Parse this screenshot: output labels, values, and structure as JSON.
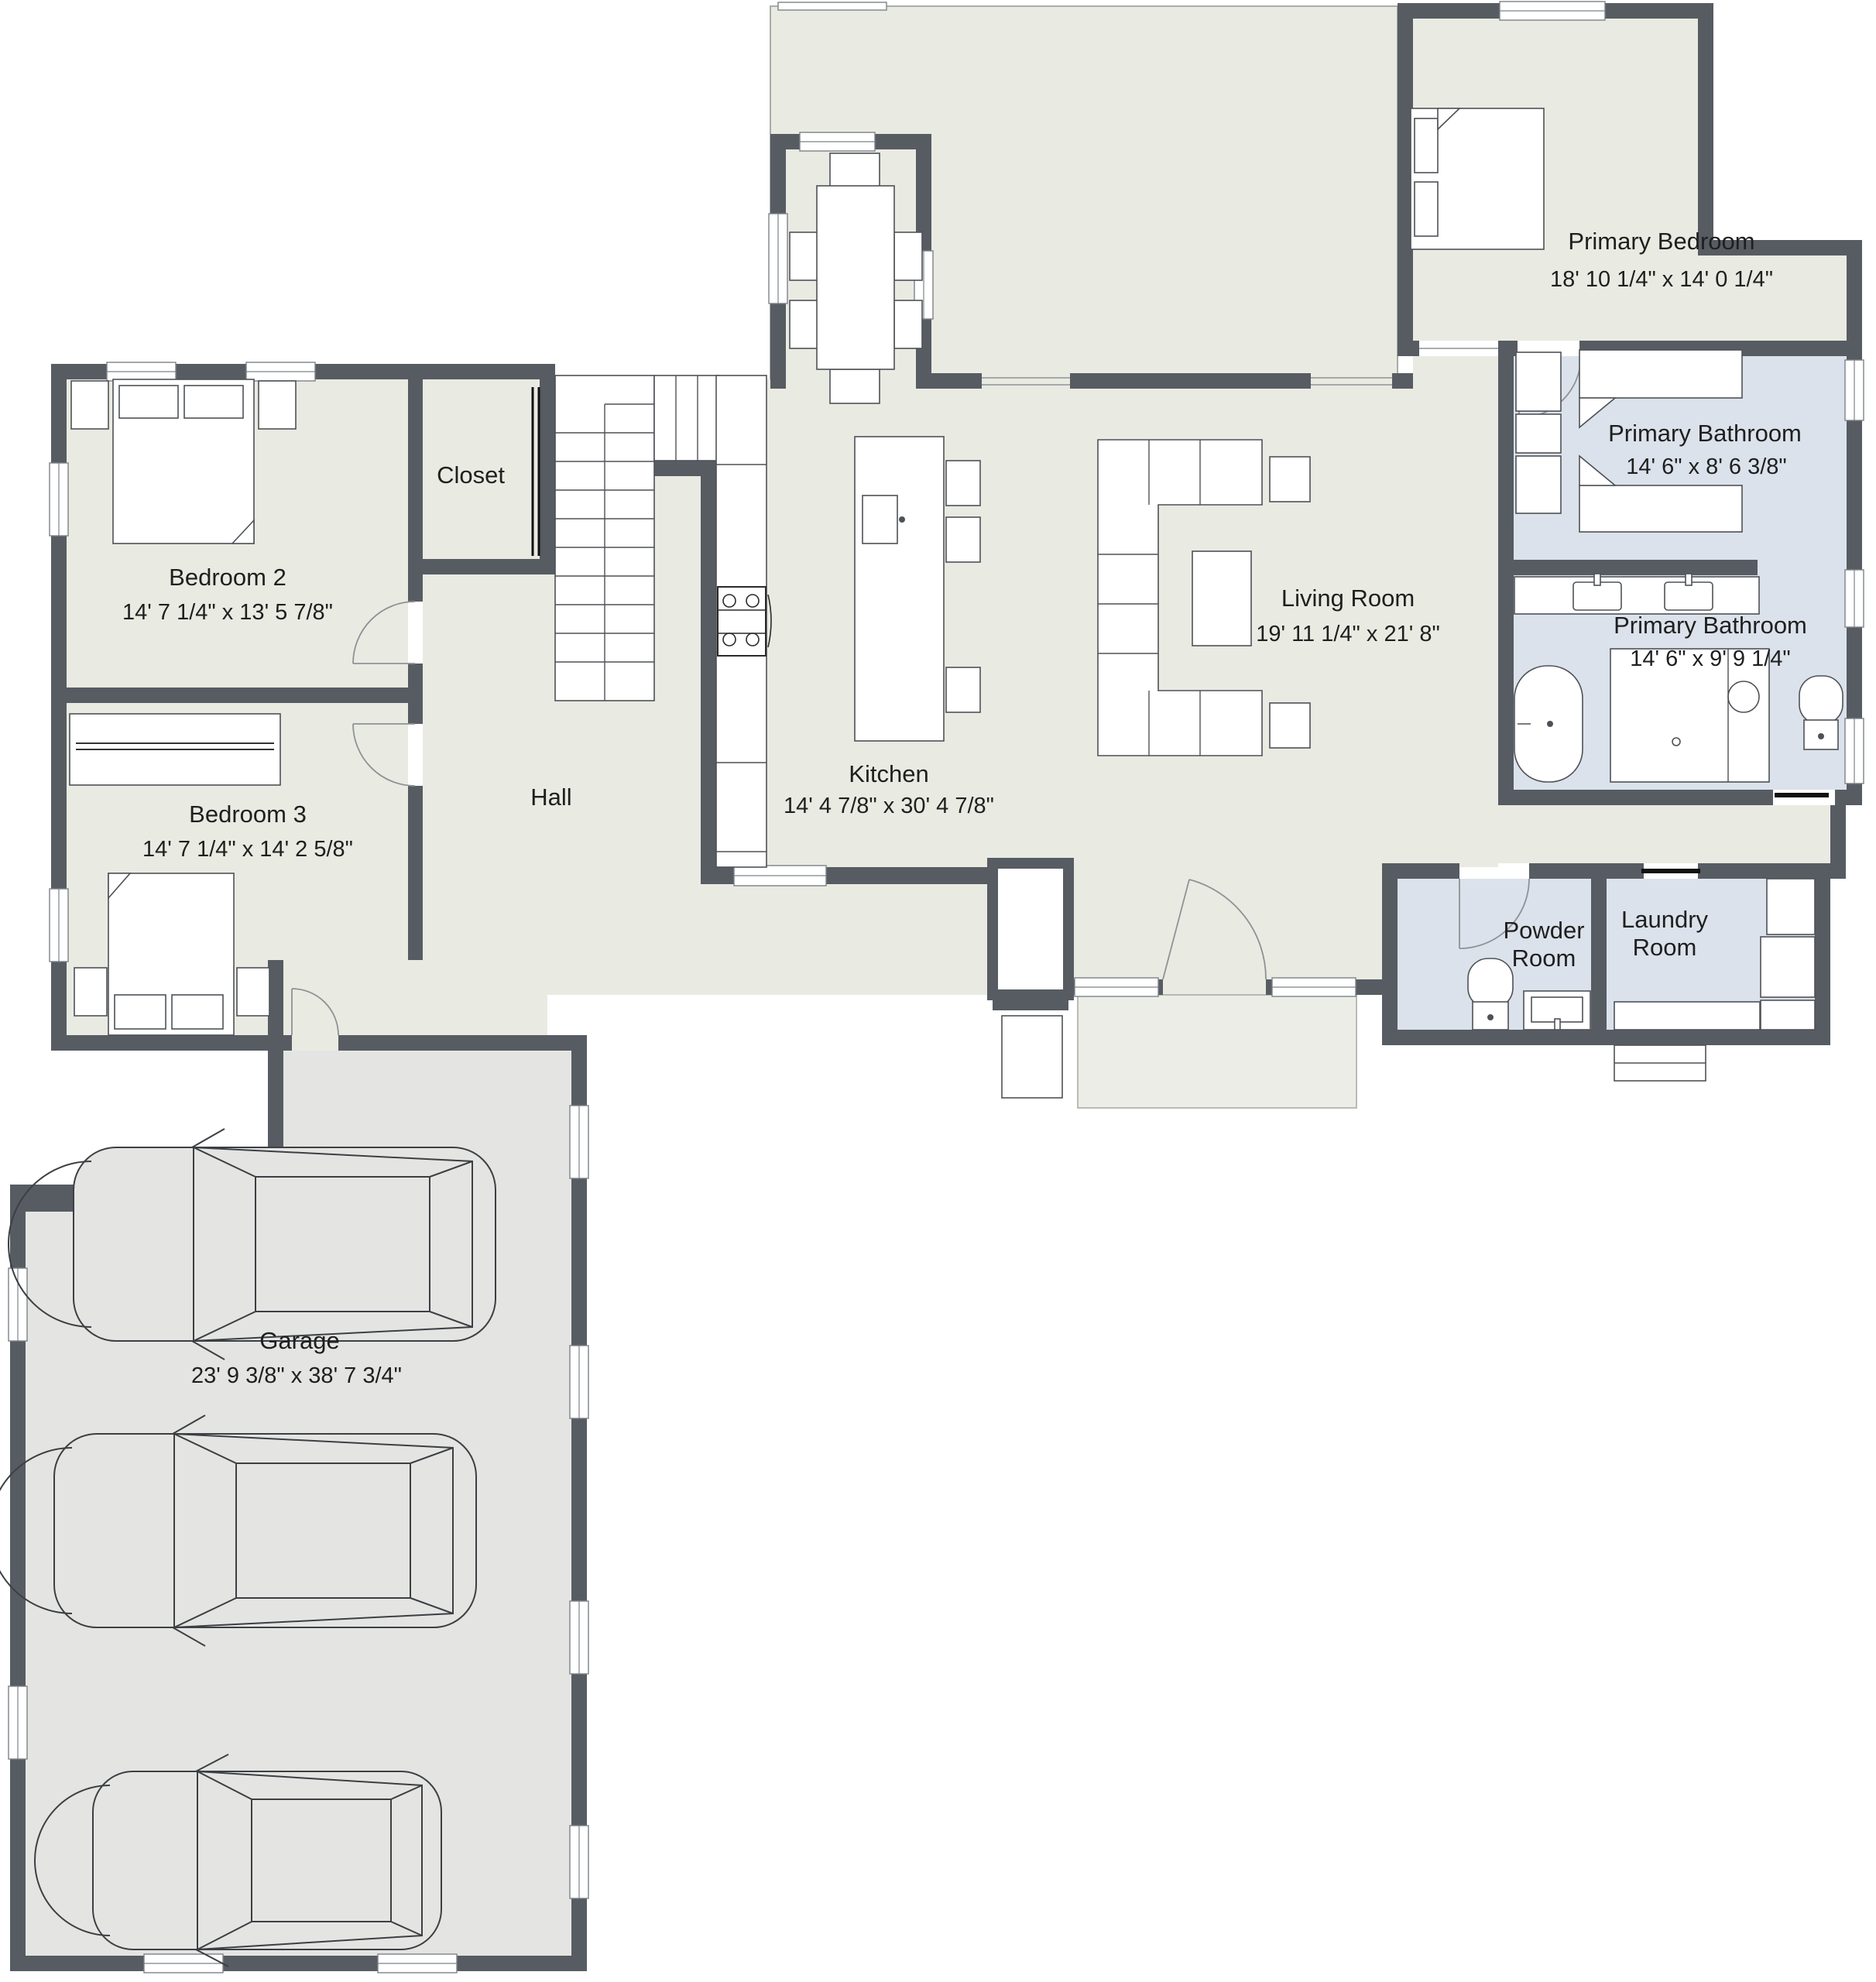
{
  "plan": {
    "title": "Floor plan",
    "colors": {
      "wall": "#575c63",
      "floor": "#e9eae2",
      "wet": "#dbe2eb",
      "gar": "#e4e5e2",
      "closet": "#e6e7e2",
      "ink": "#1f1f1f"
    },
    "rooms": {
      "primary_bedroom": {
        "name": "Primary Bedroom",
        "dims": "18' 10 1/4\" x 14' 0 1/4\""
      },
      "primary_bathroom_1": {
        "name": "Primary Bathroom",
        "dims": "14' 6\" x 8' 6 3/8\""
      },
      "primary_bathroom_2": {
        "name": "Primary Bathroom",
        "dims": "14' 6\" x 9' 9 1/4\""
      },
      "living_room": {
        "name": "Living Room",
        "dims": "19' 11 1/4\" x 21' 8\""
      },
      "kitchen": {
        "name": "Kitchen",
        "dims": "14' 4 7/8\" x 30' 4 7/8\""
      },
      "bedroom_2": {
        "name": "Bedroom 2",
        "dims": "14' 7 1/4\" x 13' 5 7/8\""
      },
      "bedroom_3": {
        "name": "Bedroom 3",
        "dims": "14' 7 1/4\" x 14' 2 5/8\""
      },
      "hall": {
        "name": "Hall"
      },
      "closet": {
        "name": "Closet"
      },
      "powder_room": {
        "name": "Powder",
        "name2": "Room"
      },
      "laundry_room": {
        "name": "Laundry",
        "name2": "Room"
      },
      "garage": {
        "name": "Garage",
        "dims": "23' 9 3/8\" x 38' 7 3/4\""
      }
    }
  }
}
